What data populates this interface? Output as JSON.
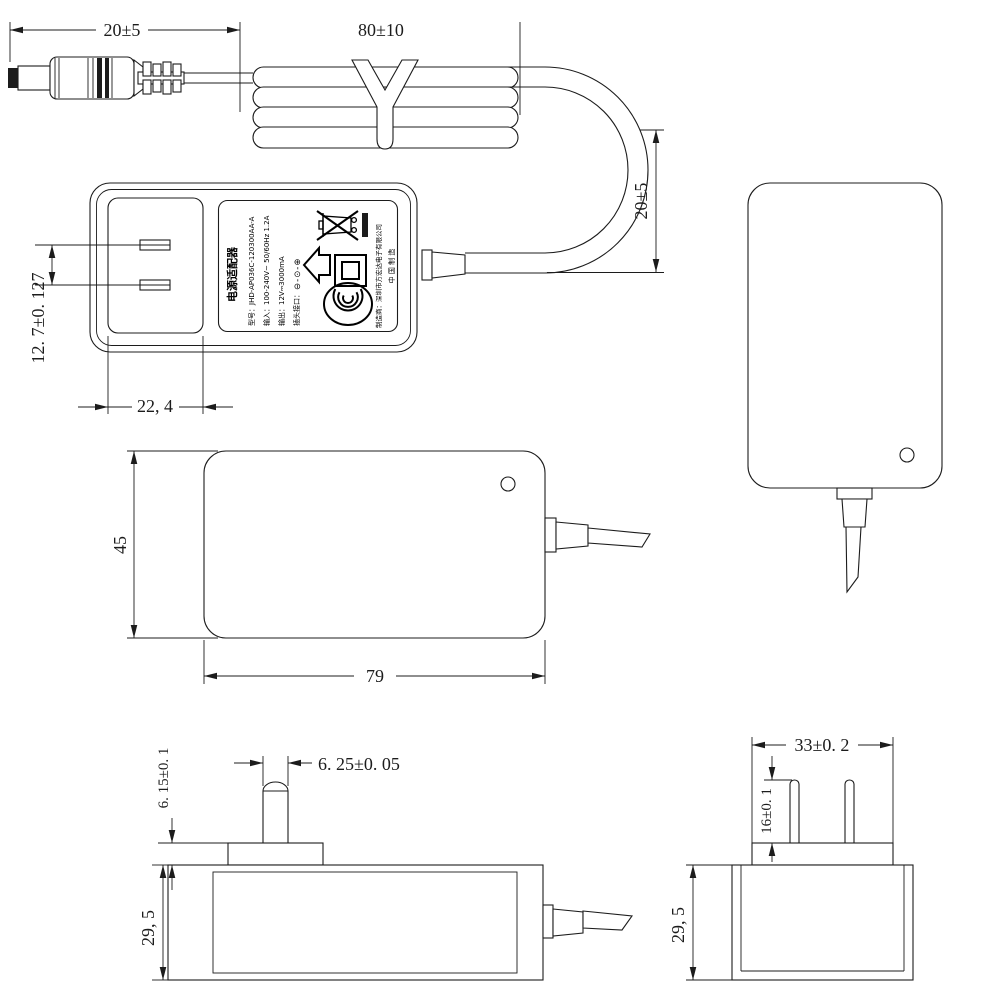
{
  "dimensions": {
    "plug_cable_length": "20±5",
    "coiled_cable_length": "80±10",
    "cable_loop_height": "20±5",
    "blade_pitch": "12. 7±0. 127",
    "plug_base_front_width": "22, 4",
    "body_height": "45",
    "body_length": "79",
    "blade_width": "6. 25±0. 05",
    "plug_base_thickness": "6. 15±0. 1",
    "body_depth_side": "29, 5",
    "plug_base_width": "33±0. 2",
    "blade_length": "16±0. 1",
    "body_depth_end": "29, 5"
  },
  "label": {
    "product_name": "电源适配器",
    "model": "型号：JHD-AP036C-120300AA-A",
    "input": "输入：100-240V~ 50/60Hz 1.2A",
    "output": "输出：12V⎓3000mA",
    "port": "插头接口：",
    "polarity": "⊖-⊙-⊕",
    "manufacturer": "制造商：深圳市方宏达电子有限公司",
    "made_in": "中 国 制 造"
  },
  "icons": {
    "weee": "weee-crossed-bin-icon",
    "indoor_use": "indoor-use-house-icon",
    "class_ii": "class-ii-double-square-icon",
    "ccc": "ccc-certification-icon",
    "polarity": "center-positive-polarity-icon"
  },
  "colors": {
    "line": "#1c1c1c",
    "background": "#ffffff"
  }
}
